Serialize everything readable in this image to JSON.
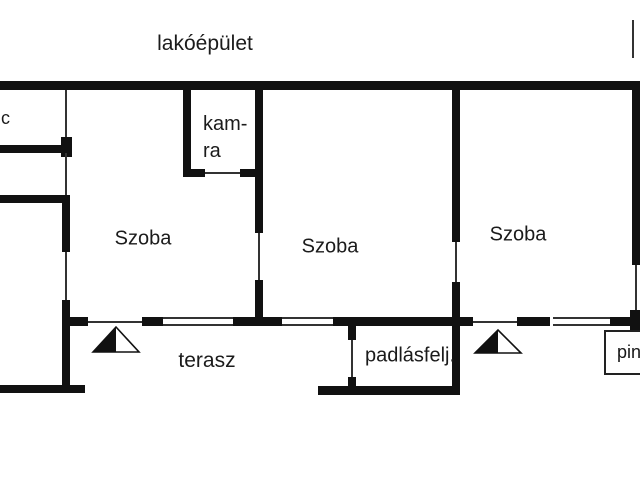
{
  "page": {
    "background": "#ffffff",
    "ink": "#111111"
  },
  "floorplan": {
    "building_label": "lakóépület",
    "rooms": {
      "wc_partial": "c",
      "kamra_line1": "kam-",
      "kamra_line2": "ra",
      "szoba_1": "Szoba",
      "szoba_2": "Szoba",
      "szoba_3": "Szoba",
      "terasz": "terasz",
      "padlasfeljaro": "padlásfelj.",
      "pince_partial": "pin"
    }
  }
}
